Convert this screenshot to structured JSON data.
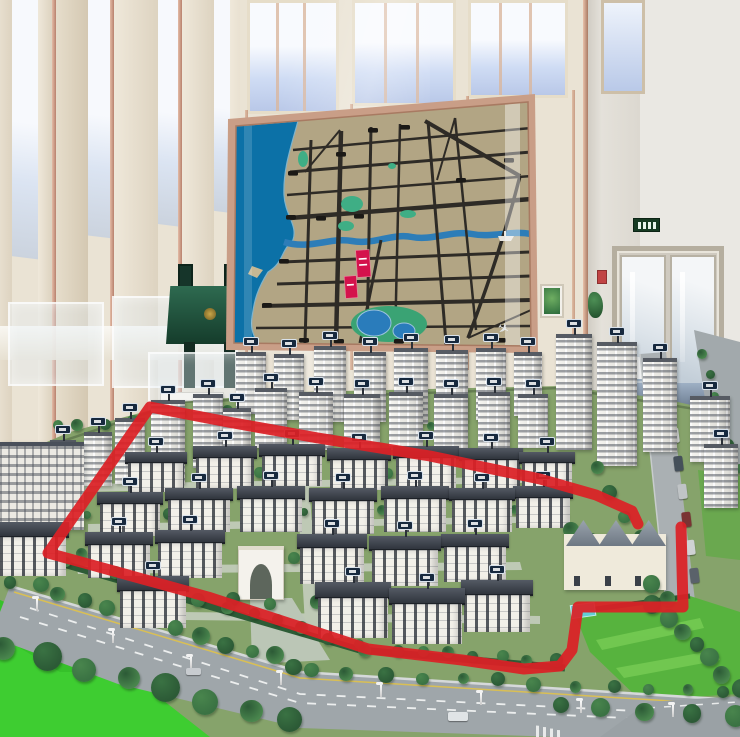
{
  "meta": {
    "width": 740,
    "height": 737,
    "scene": "real-estate sales gallery: architectural scale model of a residential district with a wall-mounted city location map; a red marker outline is drawn around the low-rise phase of the model"
  },
  "colors": {
    "red_annotation": "#dc2026",
    "wall_cream": "#eae3d4",
    "wall_trim": "#c79a87",
    "marble_right": "#eae8e3",
    "map_frame": "#c99e87",
    "map_land": "#b2a584",
    "map_sea": "#0c71a7",
    "map_road": "#2e2b26",
    "map_river": "#2d7db8",
    "map_green": "#3fae85",
    "map_lake": "#2a7cbb",
    "map_parcel": "#d4124c",
    "model_white": "#f2f0ea",
    "model_roof": "#3b4049",
    "base_bright": "#3ecd31",
    "lawn": "#57b33e",
    "road_gray": "#9fa6aa",
    "tree_a": "#2c5a36",
    "tree_b": "#3a7243",
    "tree_c": "#49854d"
  },
  "annotation": {
    "label": "red-marker-outline",
    "points": "638,524 632,511 596,495 540,479 430,456 318,438 228,422 150,407 48,553 128,575 208,597 288,623 368,649 462,660 524,669 560,666 572,650 578,607 683,607 681,527"
  },
  "map_panel": {
    "parcels": [
      {
        "x": 356,
        "y": 250,
        "w": 14,
        "h": 27
      },
      {
        "x": 345,
        "y": 276,
        "w": 12,
        "h": 22
      }
    ],
    "icons": [
      "ship-icon",
      "airplane-icon"
    ],
    "plane_glyph": "✈"
  },
  "model": {
    "towers": [
      [
        236,
        352,
        30,
        62
      ],
      [
        274,
        354,
        30,
        66
      ],
      [
        314,
        346,
        32,
        76
      ],
      [
        354,
        352,
        32,
        70
      ],
      [
        394,
        348,
        34,
        76
      ],
      [
        436,
        350,
        32,
        72
      ],
      [
        476,
        348,
        30,
        72
      ],
      [
        514,
        352,
        28,
        64
      ],
      [
        255,
        388,
        32,
        60
      ],
      [
        299,
        392,
        34,
        58
      ],
      [
        344,
        394,
        36,
        56
      ],
      [
        389,
        392,
        34,
        58
      ],
      [
        434,
        394,
        34,
        56
      ],
      [
        478,
        392,
        32,
        56
      ],
      [
        518,
        394,
        30,
        54
      ],
      [
        84,
        432,
        28,
        54
      ],
      [
        115,
        418,
        30,
        66
      ],
      [
        151,
        400,
        34,
        84
      ],
      [
        193,
        394,
        30,
        74
      ],
      [
        223,
        408,
        28,
        62
      ],
      [
        50,
        440,
        26,
        46
      ],
      [
        556,
        334,
        36,
        116
      ],
      [
        597,
        342,
        40,
        124
      ],
      [
        643,
        358,
        34,
        94
      ],
      [
        690,
        396,
        40,
        66
      ],
      [
        704,
        444,
        34,
        64
      ]
    ],
    "lowrises": [
      [
        128,
        452,
        56,
        40
      ],
      [
        196,
        446,
        58,
        42
      ],
      [
        262,
        444,
        60,
        42
      ],
      [
        330,
        448,
        58,
        42
      ],
      [
        396,
        446,
        60,
        44
      ],
      [
        462,
        448,
        58,
        42
      ],
      [
        522,
        452,
        50,
        40
      ],
      [
        100,
        492,
        60,
        44
      ],
      [
        168,
        488,
        62,
        44
      ],
      [
        240,
        486,
        62,
        46
      ],
      [
        312,
        488,
        62,
        46
      ],
      [
        384,
        486,
        62,
        46
      ],
      [
        452,
        488,
        60,
        44
      ],
      [
        516,
        486,
        54,
        42
      ],
      [
        88,
        532,
        62,
        46
      ],
      [
        158,
        530,
        64,
        48
      ],
      [
        300,
        534,
        64,
        50
      ],
      [
        372,
        536,
        66,
        50
      ],
      [
        444,
        534,
        62,
        48
      ],
      [
        120,
        576,
        66,
        52
      ],
      [
        318,
        582,
        70,
        56
      ],
      [
        392,
        588,
        70,
        56
      ],
      [
        464,
        580,
        66,
        52
      ]
    ],
    "specials": [
      {
        "type": "slab",
        "x": 0,
        "y": 442,
        "w": 84,
        "h": 88
      },
      {
        "type": "low",
        "x": 0,
        "y": 522,
        "w": 66,
        "h": 54
      },
      {
        "type": "arch",
        "x": 238,
        "y": 546,
        "w": 46,
        "h": 54
      },
      {
        "type": "club",
        "x": 564,
        "y": 534,
        "w": 102,
        "h": 56
      }
    ],
    "tree_rows": [
      [
        14,
        580,
        296,
        664,
        13,
        6,
        9
      ],
      [
        308,
        670,
        726,
        694,
        12,
        5,
        8
      ],
      [
        6,
        648,
        290,
        722,
        8,
        11,
        16
      ],
      [
        560,
        708,
        736,
        716,
        5,
        8,
        11
      ],
      [
        40,
        552,
        356,
        644,
        13,
        5,
        7
      ],
      [
        368,
        648,
        556,
        662,
        8,
        5,
        7
      ],
      [
        96,
        474,
        556,
        470,
        12,
        4,
        6
      ],
      [
        88,
        514,
        556,
        510,
        12,
        4,
        6
      ],
      [
        78,
        556,
        470,
        556,
        10,
        5,
        7
      ],
      [
        230,
        600,
        520,
        610,
        8,
        5,
        7
      ],
      [
        556,
        516,
        668,
        596,
        8,
        6,
        9
      ],
      [
        700,
        352,
        738,
        466,
        6,
        4,
        6
      ],
      [
        650,
        602,
        740,
        688,
        7,
        7,
        10
      ],
      [
        56,
        428,
        228,
        408,
        8,
        4,
        6
      ],
      [
        600,
        470,
        650,
        560,
        5,
        5,
        8
      ],
      [
        240,
        432,
        540,
        424,
        9,
        3,
        5
      ]
    ],
    "lamps": [
      [
        36,
        598
      ],
      [
        112,
        630
      ],
      [
        190,
        656
      ],
      [
        280,
        672
      ],
      [
        380,
        684
      ],
      [
        480,
        692
      ],
      [
        580,
        700
      ],
      [
        672,
        704
      ]
    ],
    "road_cars": [
      [
        448,
        712,
        20,
        9,
        "#e0e4e6"
      ],
      [
        186,
        668,
        15,
        7,
        "#c8ccd0"
      ]
    ],
    "parked_cars": [
      [
        662,
        372
      ],
      [
        666,
        400
      ],
      [
        670,
        428
      ],
      [
        674,
        456
      ],
      [
        678,
        484
      ],
      [
        682,
        512
      ],
      [
        686,
        540
      ],
      [
        690,
        568
      ]
    ],
    "parked_colors": [
      "#b8bcc0",
      "#8a2f2f",
      "#d8dadc",
      "#45505a",
      "#c0c4c6",
      "#7a3333",
      "#cfd2d4",
      "#5a626a"
    ]
  }
}
